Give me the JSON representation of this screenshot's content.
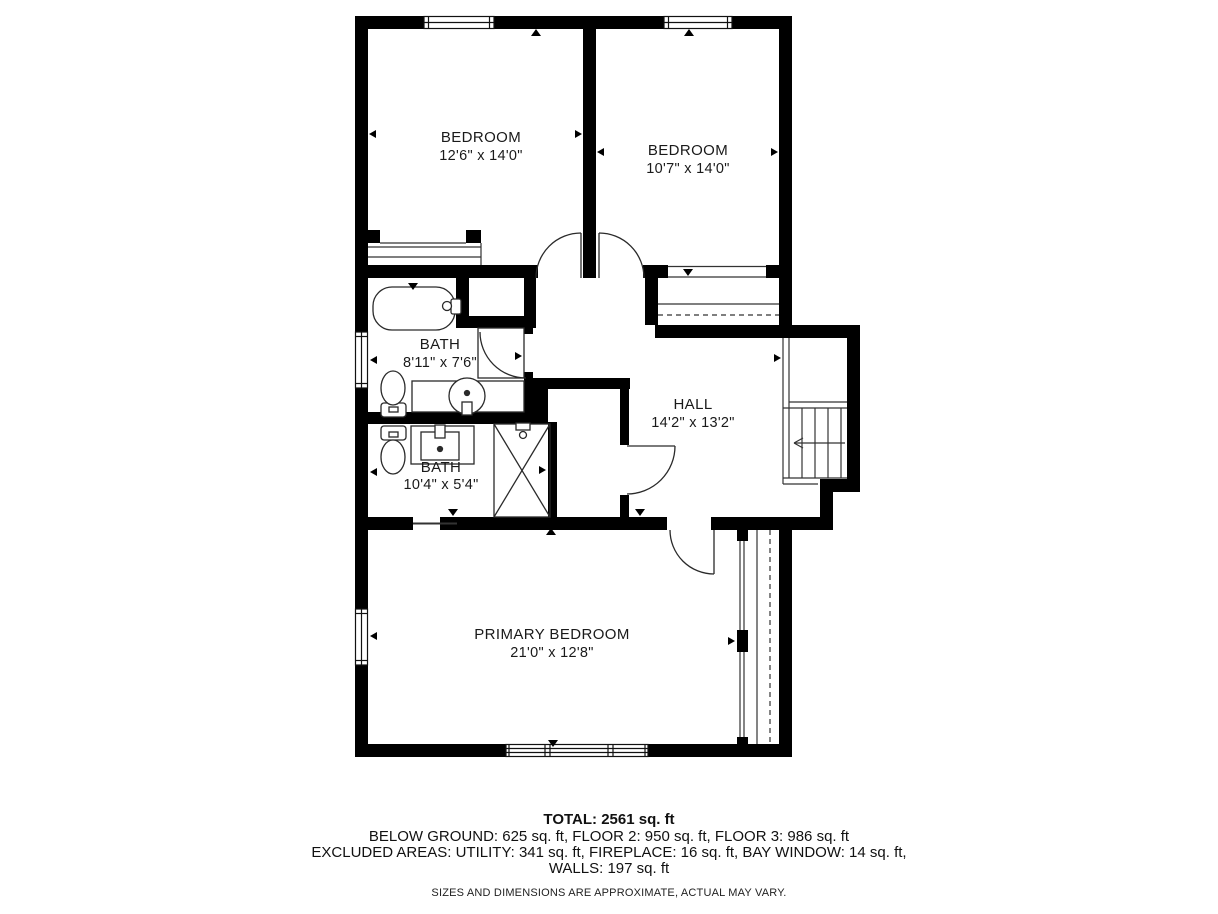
{
  "plan": {
    "rooms": [
      {
        "name": "BEDROOM",
        "dims": "12'6\" x 14'0\""
      },
      {
        "name": "BEDROOM",
        "dims": "10'7\" x 14'0\""
      },
      {
        "name": "BATH",
        "dims": "8'11\" x 7'6\""
      },
      {
        "name": "BATH",
        "dims": "10'4\" x 5'4\""
      },
      {
        "name": "HALL",
        "dims": "14'2\" x 13'2\""
      },
      {
        "name": "PRIMARY BEDROOM",
        "dims": "21'0\" x 12'8\""
      }
    ],
    "footer": {
      "total": "TOTAL: 2561 sq. ft",
      "floors": "BELOW GROUND: 625 sq. ft, FLOOR 2: 950 sq. ft, FLOOR 3: 986 sq. ft",
      "excluded": "EXCLUDED AREAS: UTILITY: 341 sq. ft, FIREPLACE: 16 sq. ft, BAY WINDOW: 14 sq. ft,",
      "walls": "WALLS: 197 sq. ft",
      "disclaimer": "SIZES AND DIMENSIONS ARE APPROXIMATE, ACTUAL MAY VARY."
    },
    "colors": {
      "wall": "#000000",
      "background": "#ffffff",
      "text": "#1a1a1a"
    }
  }
}
